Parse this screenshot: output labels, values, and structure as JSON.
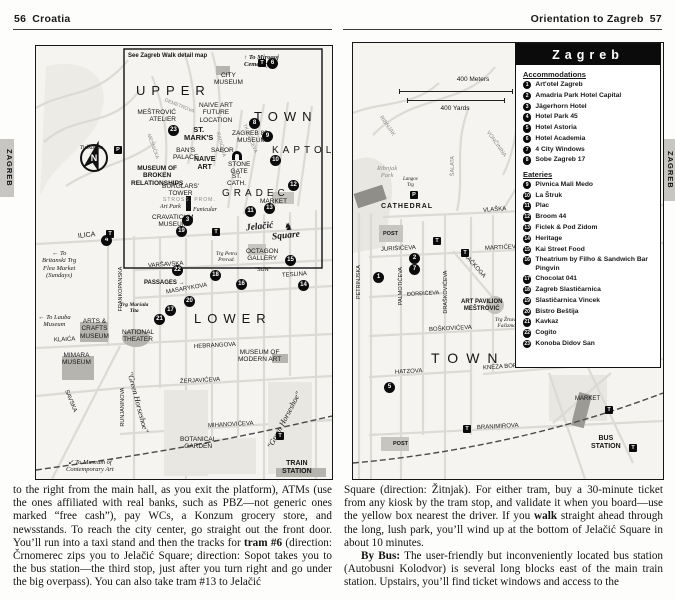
{
  "header_left": {
    "page": "56",
    "title": "Croatia"
  },
  "header_right": {
    "title": "Orientation to Zagreb",
    "page": "57"
  },
  "tab": "ZAGREB",
  "icons": {
    "tram": "T",
    "parking": "P",
    "north": "N",
    "statue": "♞"
  },
  "left_map": {
    "inset_note": "See Zagreb Walk detail map",
    "areas": {
      "upper": "UPPER",
      "town": "TOWN",
      "kaptol": "KAPTOL",
      "gradec": "GRADEC",
      "lower": "LOWER"
    },
    "square1": "Jelačić",
    "square2": "Square",
    "pois": {
      "city_museum": "CITY\nMUSEUM",
      "mestrovic": "MEŠTROVIĆ\nATELIER",
      "naive_future": "NAIVE ART\nFUTURE\nLOCATION",
      "st_marks": "ST.\nMARK'S",
      "zagreb80s": "ZAGREB 80s\nMUSEUM",
      "sabor": "SABOR",
      "bans_palace": "BAN'S\nPALACE",
      "naive_art": "NAIVE\nART",
      "broken": "MUSEUM OF\nBROKEN\nRELATIONSHIPS",
      "stone_gate": "STONE\nGATE",
      "st_cath": "ST.\nCATH.",
      "burglars": "BURGLARS'\nTOWER",
      "art_park": "Art Park",
      "funicular": "Funicular",
      "cravaticum": "CRAVATICUM\nMUSEUM",
      "market": "MARKET",
      "octagon": "OCTAGON\nGALLERY",
      "trg_petra": "Trg Petra\nPrerad.",
      "sun": "\"SUN\"",
      "trg_marsala": "Trg Maršala\nTita",
      "arts_crafts": "ARTS &\nCRAFTS\nMUSEUM",
      "national_theater": "NATIONAL\nTHEATER",
      "modern_art": "MUSEUM OF\nMODERN ART",
      "mimara": "MIMARA\nMUSEUM",
      "botanical": "BOTANICAL\nGARDEN",
      "train_station": "TRAIN\nSTATION"
    },
    "streets": {
      "ilica": "ILICA",
      "frankopanska": "FRANKOPANSKA",
      "varsavska": "VARŠAVSKA",
      "masarykova": "MASARYKOVA",
      "teslina": "TESLINA",
      "passages": "PASSAGES →",
      "hebrangova": "HEBRANGOVA",
      "klaica": "KLAIĆA",
      "zerjaviceva": "ŽERJAVIĆEVA",
      "runjaninova": "RUNJANINOVA",
      "savska": "SAVSKA",
      "mihanoviceva": "MIHANOVIĆEVA",
      "demetrova": "DEMETROVA",
      "mesnicka": "MESNIČKA",
      "radiceva": "RADIĆEVA",
      "tkalciceva": "TKALČIĆEVA",
      "stross": "STROSS. PROM.",
      "green_horseshoe": "\"Green Horseshoe\""
    },
    "notes": {
      "mirogoj": "↑ To Mirogoj\nCemetery",
      "britanski": "← To\nBritanski Trg\nFlea Market\n(Sundays)",
      "lauba": "← To Lauba\nMuseum",
      "contemporary": "↙ To Museum of\nContemporary Art",
      "tuskanac": "Tuškanac"
    },
    "markers": [
      "6",
      "8",
      "23",
      "9",
      "10",
      "12",
      "13",
      "11",
      "3",
      "19",
      "4",
      "22",
      "18",
      "16",
      "15",
      "14",
      "20",
      "17",
      "21"
    ]
  },
  "right_map": {
    "scale_meters": "400 Meters",
    "scale_yards": "400 Yards",
    "area_town": "TOWN",
    "pois": {
      "ribnjak_park": "Ribnjak\nPark",
      "langov": "Langov\nTrg",
      "cathedral": "CATHEDRAL",
      "post": "POST",
      "art_pavilion": "ART PAVILION\nMEŠTROVIĆ",
      "trg_zrtava": "Trg Žrtava\nFašizma",
      "market": "MARKET",
      "bus_station": "BUS\nSTATION"
    },
    "streets": {
      "vlaska": "VLAŠKA",
      "jurisiceva": "JURIŠIĆEVA",
      "marticeva": "MARTIĆEVA",
      "rackoga": "RAČKOGA",
      "palmoticeva": "PALMOTIĆEVA",
      "dordiceva": "ĐORĐIĆEVA",
      "draskoviceva": "DRAŠKOVIĆEVA",
      "petrinjska": "PETRINJSKA",
      "boskoviceva": "BOŠKOVIĆEVA",
      "hatzova": "HATZOVA",
      "kneza_borne": "KNEZA BORNE",
      "branimirova": "BRANIMIROVA",
      "salata": "ŠALATA",
      "ribnjak": "RIBNJAK",
      "voncinina": "VONČININA"
    },
    "markers": [
      "2",
      "7",
      "1",
      "5"
    ]
  },
  "legend": {
    "title": "Zagreb",
    "accommodations_heading": "Accommodations",
    "accommodations": [
      {
        "n": "1",
        "label": "Art'otel Zagreb"
      },
      {
        "n": "2",
        "label": "Amadria Park Hotel Capital"
      },
      {
        "n": "3",
        "label": "Jägerhorn Hotel"
      },
      {
        "n": "4",
        "label": "Hotel Park 45"
      },
      {
        "n": "5",
        "label": "Hotel Astoria"
      },
      {
        "n": "6",
        "label": "Hotel Academia"
      },
      {
        "n": "7",
        "label": "4 City Windows"
      },
      {
        "n": "8",
        "label": "Sobe Zagreb 17"
      }
    ],
    "eateries_heading": "Eateries",
    "eateries": [
      {
        "n": "9",
        "label": "Pivnica Mali Medo"
      },
      {
        "n": "10",
        "label": "La Štruk"
      },
      {
        "n": "11",
        "label": "Plac"
      },
      {
        "n": "12",
        "label": "Broom 44"
      },
      {
        "n": "13",
        "label": "Ficlek & Pod Zidom"
      },
      {
        "n": "14",
        "label": "Heritage"
      },
      {
        "n": "15",
        "label": "Kai Street Food"
      },
      {
        "n": "16",
        "label": "Theatrium by Filho & Sandwich Bar Pingvin"
      },
      {
        "n": "17",
        "label": "Chocolat 041"
      },
      {
        "n": "18",
        "label": "Zagreb Slastičarnica"
      },
      {
        "n": "19",
        "label": "Slastičarnica Vincek"
      },
      {
        "n": "20",
        "label": "Bistro Beštija"
      },
      {
        "n": "21",
        "label": "Kavkaz"
      },
      {
        "n": "22",
        "label": "Cogito"
      },
      {
        "n": "23",
        "label": "Konoba Didov San"
      }
    ]
  },
  "body": {
    "left_col": {
      "pre": "to the right from the main hall, as you exit the platform), ATMs (use the ones affiliated with real banks, such as PBZ—not generic ones marked “free cash”), pay WCs, a Konzum grocery store, and newsstands. To reach the city center, go straight out the front door. You’ll run into a taxi stand and then the tracks for ",
      "bold": "tram #6",
      "post": " (direction: Črnomerec zips you to Jelačić Square; direction: Sopot takes you to the bus station—the third stop, just after you turn right and go under the big overpass). You can also take tram #13 to Jelačić"
    },
    "right_col": {
      "p1_pre": "Square (direction: Žitnjak). For either tram, buy a 30-minute ticket from any kiosk by the tram stop, and validate it when you board—use the yellow box nearest the driver. If you ",
      "p1_bold": "walk",
      "p1_post": " straight ahead through the long, lush park, you’ll wind up at the bottom of Jelačić Square in about 10 minutes.",
      "p2_bold": "By Bus:",
      "p2_text": " The user-friendly but inconveniently located bus station (Autobusni Kolodvor) is several long blocks east of the main train station. Upstairs, you’ll find ticket windows and access to the"
    }
  }
}
